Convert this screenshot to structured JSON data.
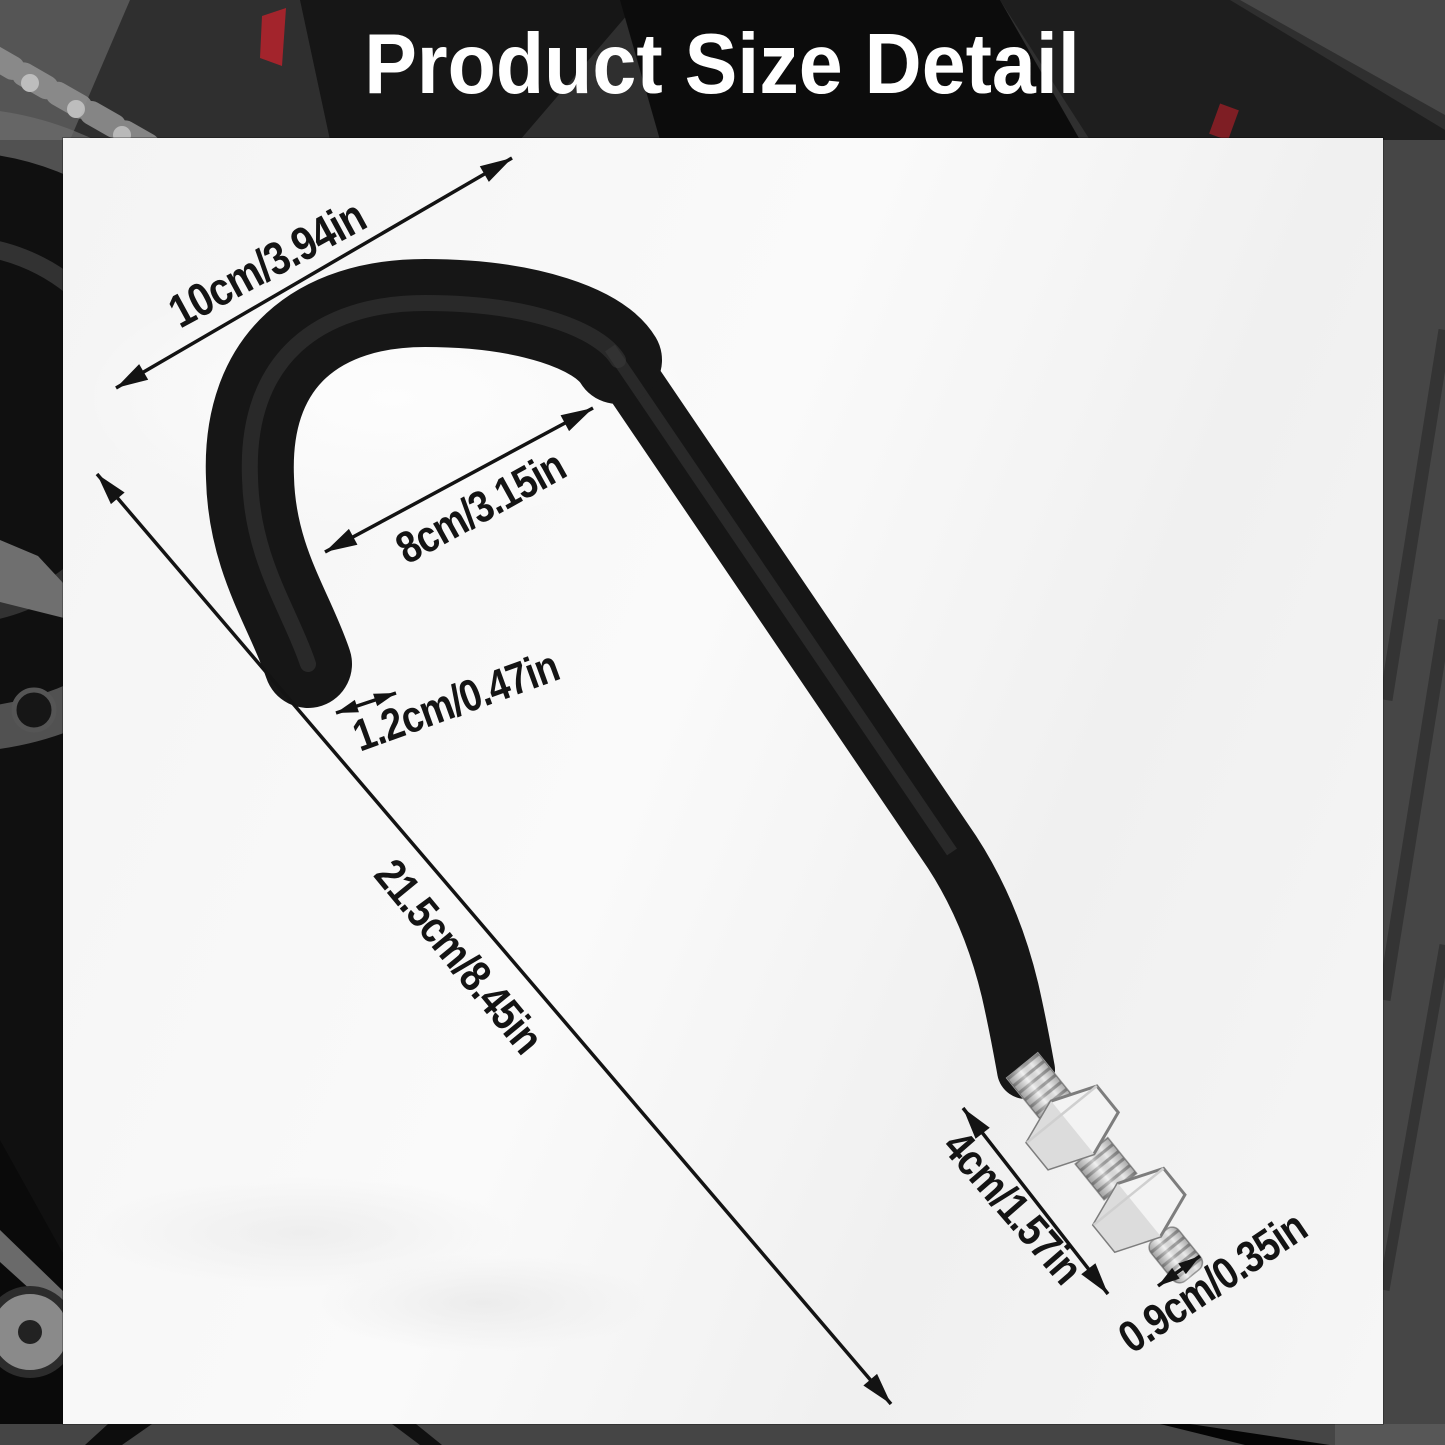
{
  "title": "Product Size Detail",
  "colors": {
    "annotation": "#141414",
    "title_text": "#ffffff",
    "hook_black": "#161616",
    "metal_silver": "#ececec",
    "panel_background": "#f5f5f5",
    "accent_red": "#a3242c"
  },
  "dimensions": [
    {
      "name": "hook-opening-width",
      "label": "10cm/3.94in",
      "cm": 10,
      "inches": 3.94
    },
    {
      "name": "hook-inner-width",
      "label": "8cm/3.15in",
      "cm": 8,
      "inches": 3.15
    },
    {
      "name": "hook-tube-diameter",
      "label": "1.2cm/0.47in",
      "cm": 1.2,
      "inches": 0.47
    },
    {
      "name": "hook-total-length",
      "label": "21.5cm/8.45in",
      "cm": 21.5,
      "inches": 8.45
    },
    {
      "name": "bolt-thread-length",
      "label": "4cm/1.57in",
      "cm": 4,
      "inches": 1.57
    },
    {
      "name": "bolt-thread-diameter",
      "label": "0.9cm/0.35in",
      "cm": 0.9,
      "inches": 0.35
    }
  ]
}
